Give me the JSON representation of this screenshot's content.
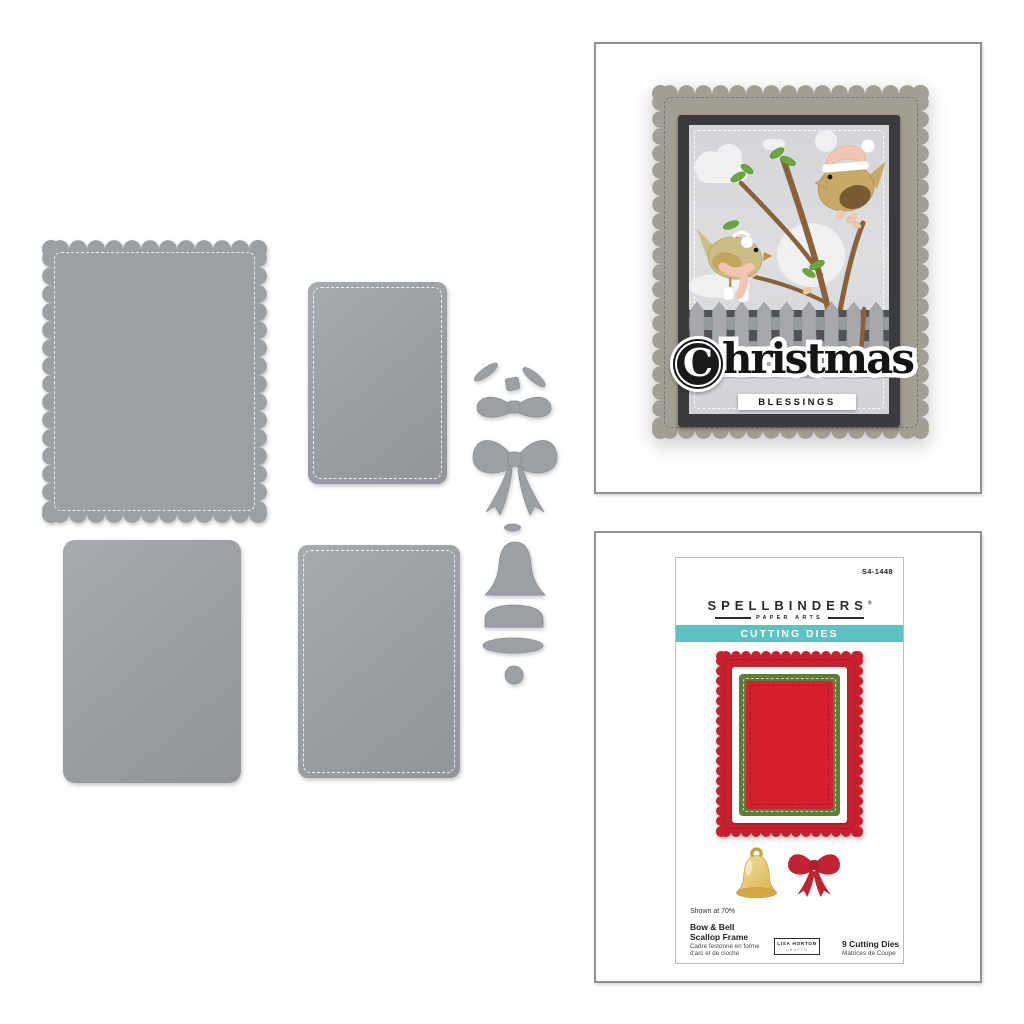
{
  "card_example": {
    "sentiment_initial": "C",
    "sentiment_rest": "hristmas",
    "sentiment_full": "Christmas",
    "sentiment_sub": "BLESSINGS"
  },
  "package": {
    "sku": "S4-1448",
    "brand": "SPELLBINDERS",
    "brand_mark": "®",
    "subbrand": "PAPER ARTS",
    "category": "CUTTING DIES",
    "shown_at": "Shown at 70%",
    "title_en_line1": "Bow & Bell",
    "title_en_line2": "Scallop Frame",
    "title_fr_line1": "Cadre festonné en forme",
    "title_fr_line2": "d'arc et de cloche",
    "designer": "LISA HORTON",
    "designer_sub": "CRAFTS",
    "count_en": "9 Cutting Dies",
    "count_fr": "Matrices de Coupe"
  },
  "colors": {
    "die_metal": "#9ca0a5",
    "card_frame": "#a39e94",
    "dark_mat": "#3b3b3d",
    "teal_band": "#5fc1c2",
    "frame_red": "#c8202e",
    "frame_green": "#5c7e36",
    "bow_red": "#c32330",
    "bell_gold": "#e3c06a",
    "bird_tan": "#c9a967",
    "accent_pink": "#f2c6b2",
    "branch_brown": "#8a6138",
    "leaf_green": "#6aa83c"
  },
  "dies": {
    "shapes": [
      "scalloped-frame",
      "stitched-rectangle-large",
      "rectangle",
      "stitched-rectangle-small",
      "bow-tail-ends",
      "bow-knot",
      "small-bow",
      "large-bow",
      "bell-hanger",
      "bell-body",
      "bell-rim",
      "bell-lip",
      "bell-clapper"
    ]
  }
}
